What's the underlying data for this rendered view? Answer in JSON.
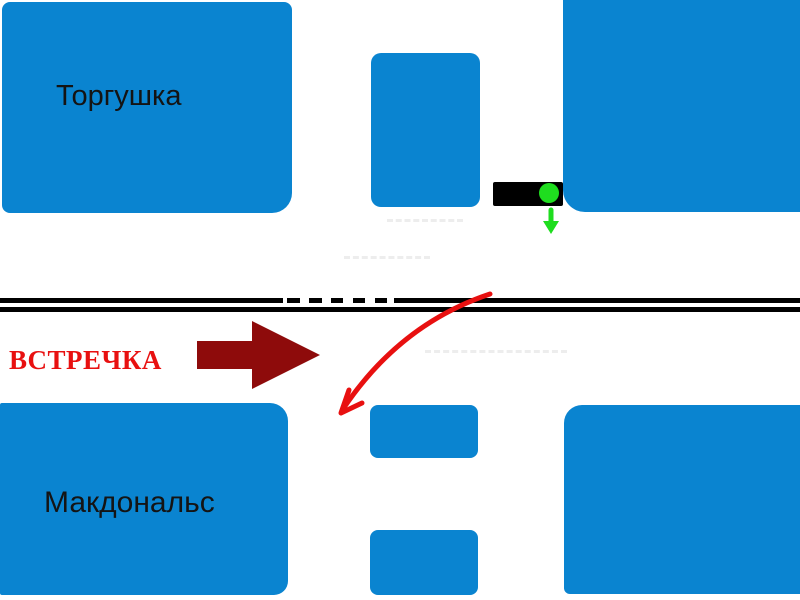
{
  "diagram": {
    "title_hint": "hand-drawn road intersection scheme",
    "labels": {
      "top_left_building": "Торгушка",
      "bottom_left_building": "Макдональс",
      "oncoming_traffic": "ВСТРЕЧКА"
    },
    "icons": [
      {
        "name": "traffic-light-icon",
        "shape": "black horizontal box with green round signal"
      },
      {
        "name": "green-down-arrow-icon",
        "shape": "short green arrow pointing down"
      },
      {
        "name": "oncoming-arrow-icon",
        "shape": "dark red block arrow pointing right"
      },
      {
        "name": "turn-path-arrow-icon",
        "shape": "red curved arrow crossing road toward lower-left"
      },
      {
        "name": "road-centerline",
        "shape": "double black line, upper line dashed in the middle"
      }
    ],
    "colors": {
      "background": "#ffffff",
      "building_blue": "#0a84d0",
      "road_black": "#000000",
      "oncoming_text_red": "#e81010",
      "oncoming_arrow_darkred": "#8e0b0b",
      "path_arrow_red": "#e81010",
      "signal_green": "#1fdd1f",
      "traffic_light_black": "#000000",
      "faint_artifact_gray": "#ededed"
    }
  }
}
